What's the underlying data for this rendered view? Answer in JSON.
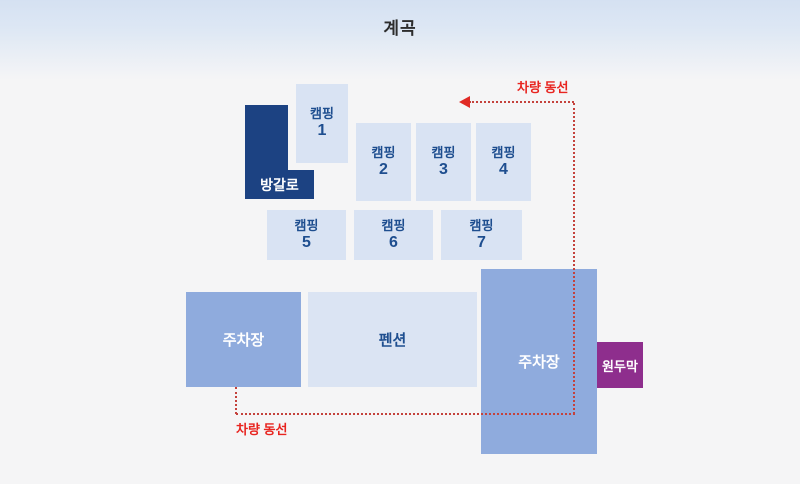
{
  "title": "계곡",
  "legend": {
    "route_label_top": "차량 동선",
    "route_label_bottom": "차량 동선"
  },
  "zones": {
    "bungalow": {
      "label": "방갈로",
      "color": "#1c4282"
    },
    "camps": [
      {
        "label": "캠핑",
        "number": "1"
      },
      {
        "label": "캠핑",
        "number": "2"
      },
      {
        "label": "캠핑",
        "number": "3"
      },
      {
        "label": "캠핑",
        "number": "4"
      },
      {
        "label": "캠핑",
        "number": "5"
      },
      {
        "label": "캠핑",
        "number": "6"
      },
      {
        "label": "캠핑",
        "number": "7"
      }
    ],
    "parking_left": {
      "label": "주차장",
      "color": "#8fabdd"
    },
    "pension": {
      "label": "펜션",
      "color": "#dbe4f3"
    },
    "parking_right": {
      "label": "주차장",
      "color": "#8fabdd"
    },
    "hut": {
      "label": "원두막",
      "color": "#8e2e8d"
    }
  },
  "colors": {
    "background": "#f5f5f6",
    "band_top": "#d5e1f2",
    "camp_fill": "#d9e3f3",
    "navy_text": "#1e4e8f",
    "route_red_text": "#e8241f",
    "route_red_dots": "#c4423c"
  }
}
